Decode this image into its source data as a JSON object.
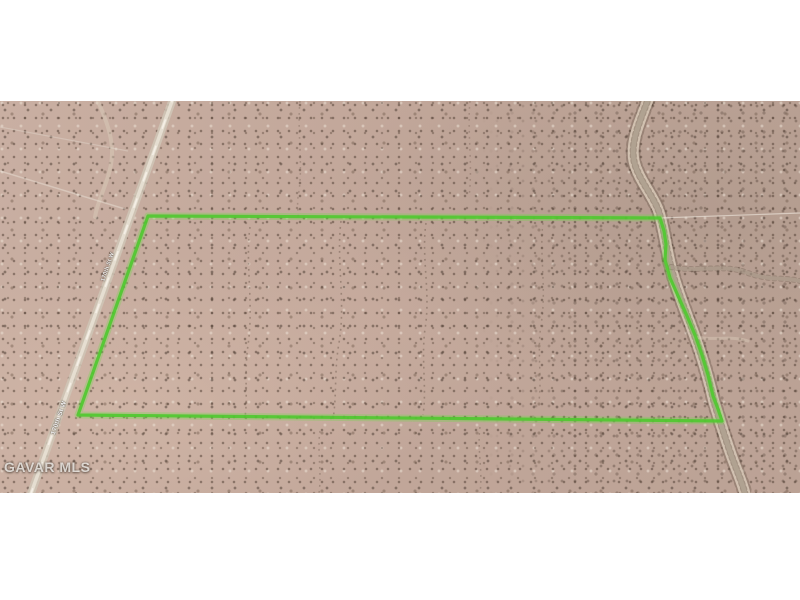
{
  "scene": {
    "description": "Aerial satellite photo of vacant speckled desert land with a bright green parcel boundary outline, a dirt road on the west side and a sandy wash meandering along the east boundary",
    "terrain_base_color": "#c2a89c",
    "wash_color": "#d7c8b7",
    "road_color": "#cfc5b6",
    "letterbox_color": "#ffffff"
  },
  "watermark": {
    "text": "GAVAR MLS"
  },
  "road": {
    "labels": [
      {
        "text": "170th St W"
      },
      {
        "text": "170th St W"
      }
    ]
  },
  "parcel": {
    "outline_color": "#4fc92f",
    "boundary_points": "148,115 660,117 664,130 666,143 665,159 670,177 679,197 687,215 695,234 702,254 708,274 713,295 718,308 722,320 78,314"
  },
  "map_features": {
    "road_path": "M 175,-8 L 29,398",
    "main_wash_path": "M 649,-4 C 641,18 630,40 634,60 C 638,78 653,94 659,111 C 664,128 666,146 671,166 C 677,190 687,213 695,236 C 703,258 709,280 714,301 C 719,317 726,340 733,359 C 739,375 743,384 745,393",
    "wash_branch_1": "M 671,166 C 700,172 722,162 748,172 C 770,180 786,176 800,180",
    "wash_branch_2": "M 695,236 C 715,240 730,234 748,240",
    "small_wash_path": "M 96,-4 C 108,22 116,44 110,68 C 106,86 98,98 95,116",
    "fence_right_path": "M 660,117 L 800,112",
    "track_path_1": "M 0,70 L 125,108",
    "track_path_2": "M 0,26 L 128,50",
    "drainage_paths": [
      "M 341,120 C 336,160 346,200 339,242 C 334,270 337,294 333,318",
      "M 426,122 C 421,156 431,192 425,228 C 421,258 427,288 423,314",
      "M 250,126 C 245,162 254,202 248,244 C 244,274 248,296 245,316",
      "M 543,122 C 539,152 547,188 541,224 C 537,250 542,276 539,300",
      "M 320,330 C 317,350 322,372 319,392",
      "M 480,326 C 477,348 483,370 480,392",
      "M 300,0 C 297,30 303,60 299,90 C 296,104 299,112 298,116",
      "M 470,0 C 467,30 473,64 469,96"
    ]
  }
}
